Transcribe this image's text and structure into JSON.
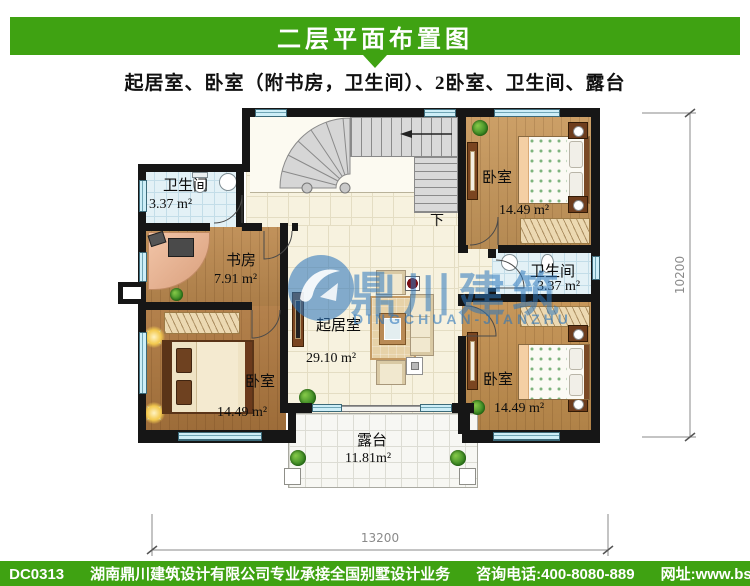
{
  "header": {
    "title": "二层平面布置图"
  },
  "subtitle": "起居室、卧室（附书房，卫生间）、2卧室、卫生间、露台",
  "plan": {
    "rooms": [
      {
        "id": "bathroom-top-left",
        "name": "卫生间",
        "area": "3.37 m²"
      },
      {
        "id": "study",
        "name": "书房",
        "area": "7.91 m²"
      },
      {
        "id": "bedroom-top-right",
        "name": "卧室",
        "area": "14.49 m²"
      },
      {
        "id": "bathroom-right",
        "name": "卫生间",
        "area": "3.37 m²"
      },
      {
        "id": "living-room",
        "name": "起居室",
        "area": "29.10 m²"
      },
      {
        "id": "bedroom-bottom-left",
        "name": "卧室",
        "area": "14.49 m²"
      },
      {
        "id": "bedroom-bottom-right",
        "name": "卧室",
        "area": "14.49 m²"
      },
      {
        "id": "terrace",
        "name": "露台",
        "area": "11.81m²"
      }
    ],
    "stair_down_label": "下",
    "dimensions": {
      "width_mm": "13200",
      "height_mm": "10200"
    }
  },
  "watermark": {
    "logo_text": "鼎川建筑",
    "logo_subtext": "DINGCHUAN-JIANZHU"
  },
  "footer": {
    "plan_no": "本图编号：DC0313",
    "company": "湖南鼎川建筑设计有限公司专业承接全国别墅设计业务",
    "phone": "咨询电话:400-8080-889",
    "website": "网址:www.bstzcs.com"
  },
  "colors": {
    "brand_green": "#3fa212",
    "watermark_blue": "#2c76bc",
    "wall_black": "#161616"
  }
}
